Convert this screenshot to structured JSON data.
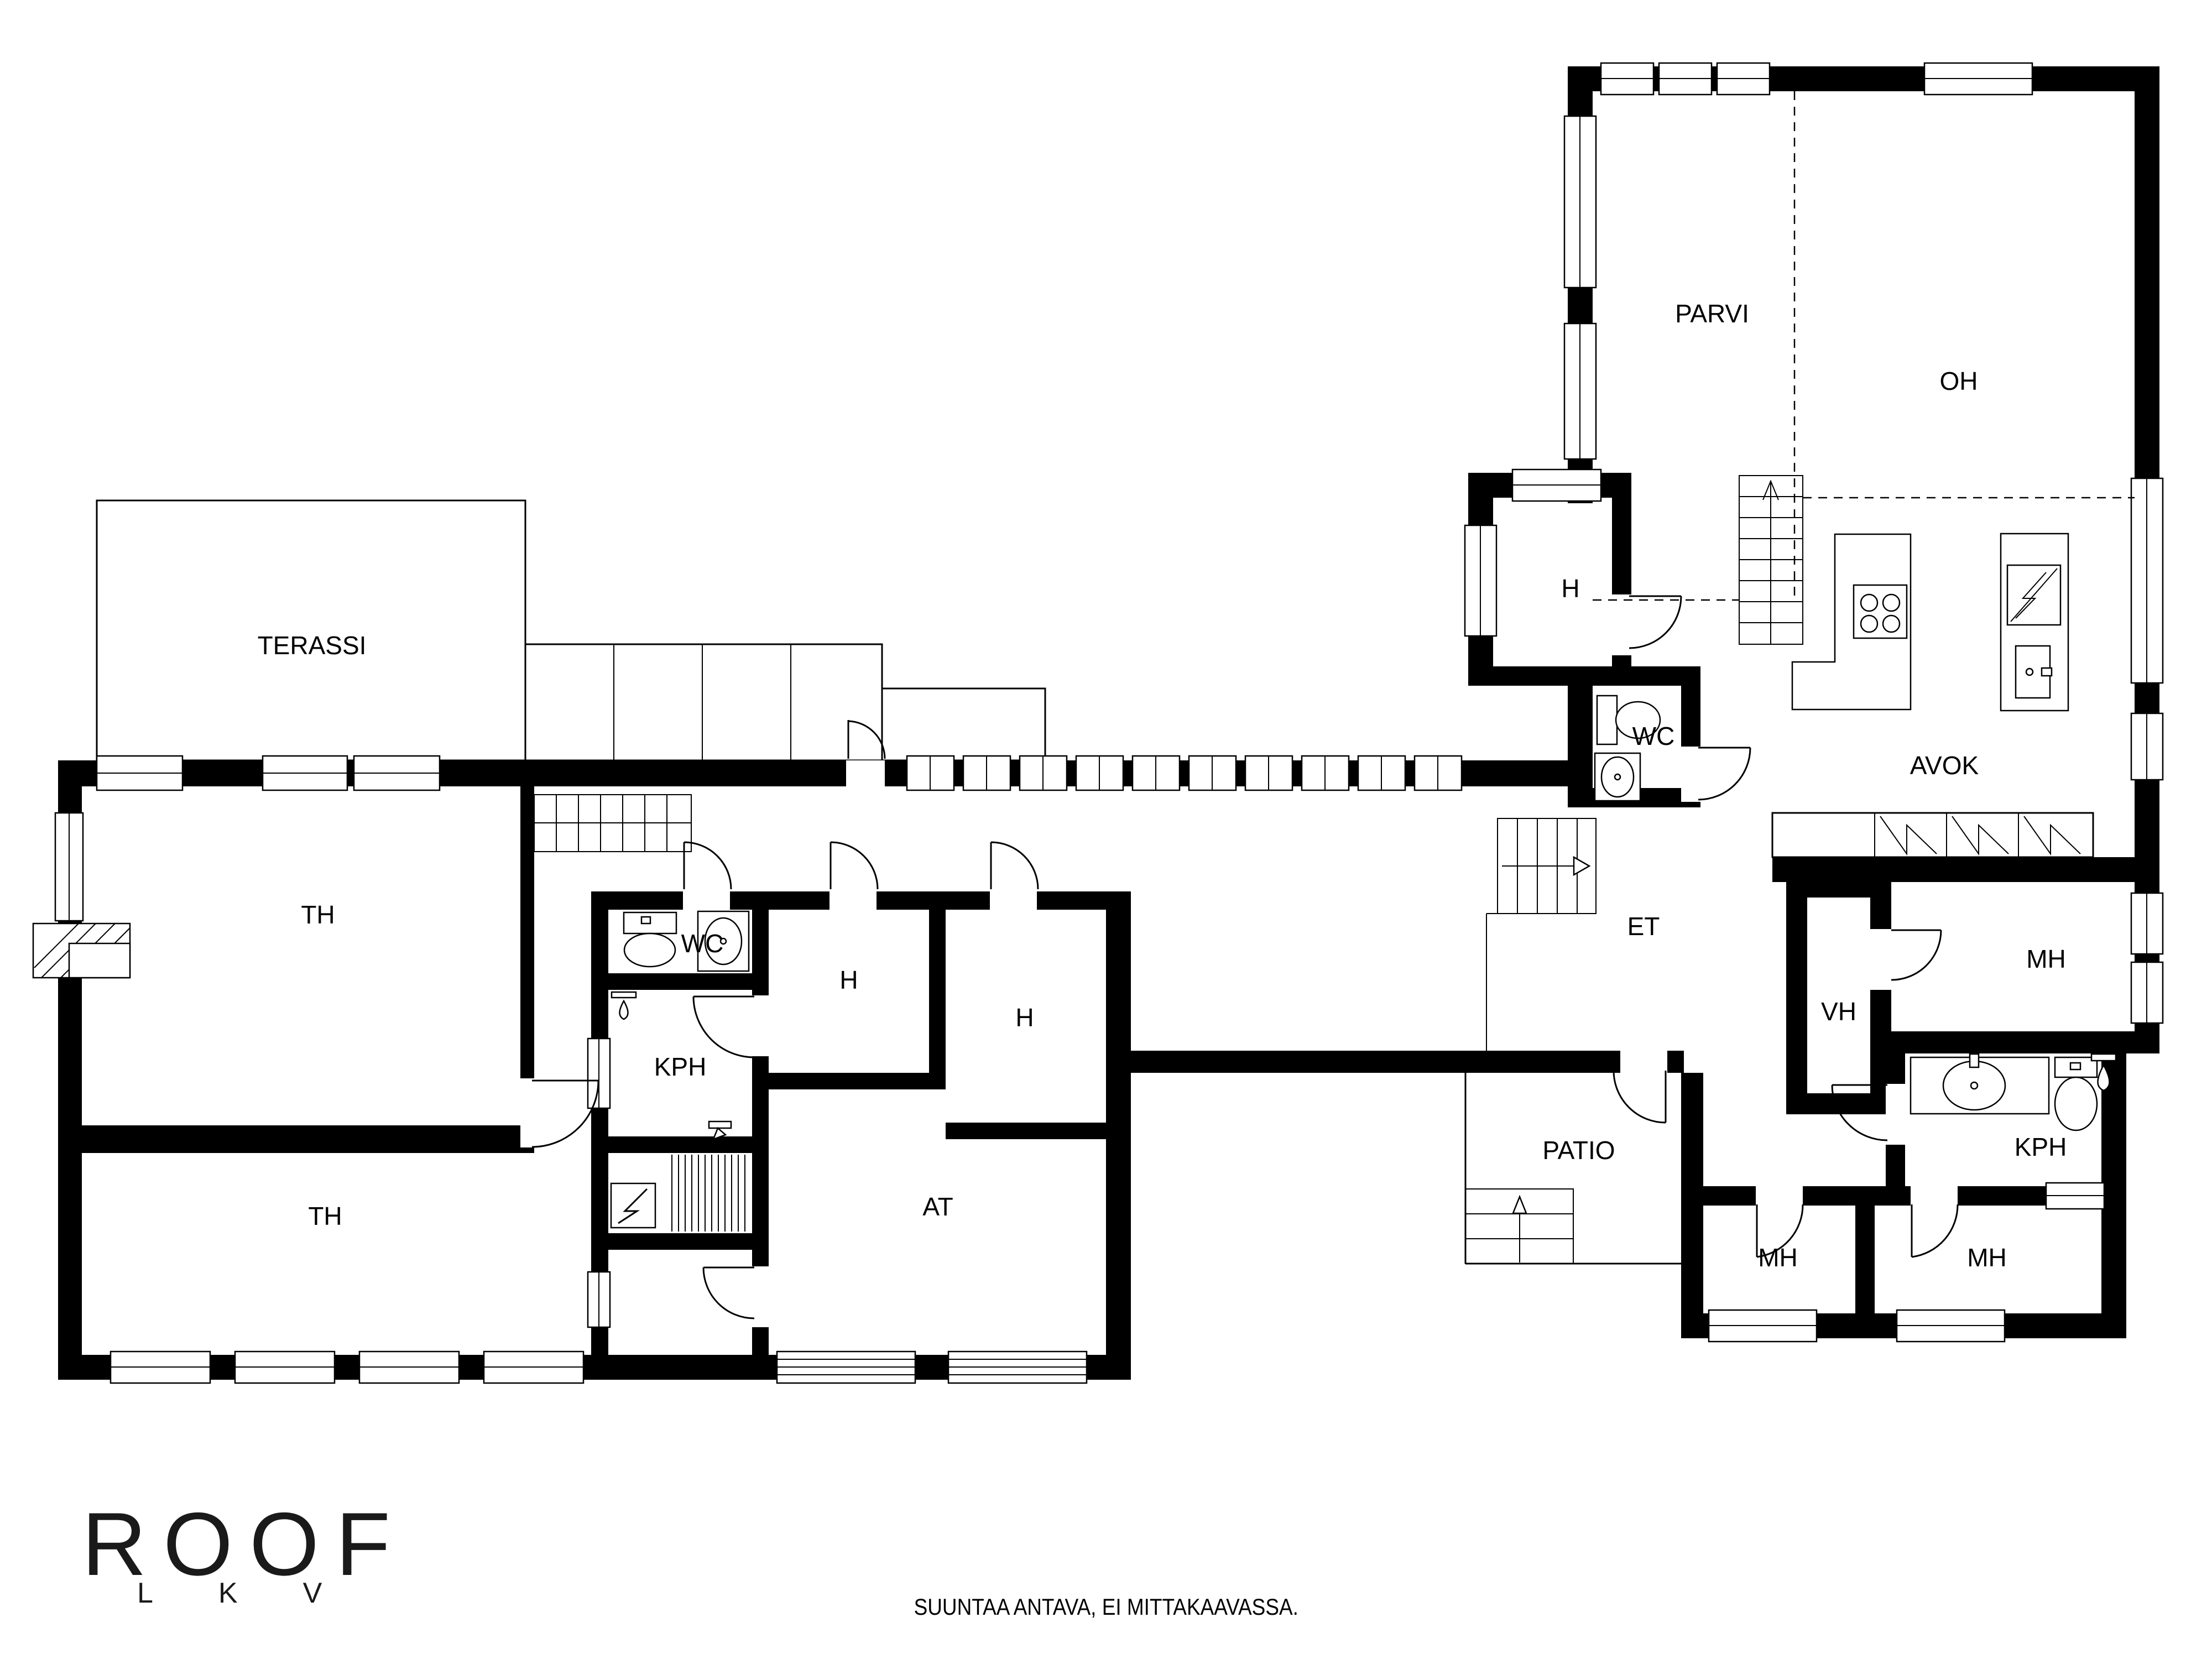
{
  "rooms": {
    "terassi": "TERASSI",
    "th_upper": "TH",
    "th_lower": "TH",
    "wc_center": "WC",
    "kph_center": "KPH",
    "h_center_1": "H",
    "h_center_2": "H",
    "at": "AT",
    "parvi": "PARVI",
    "oh": "OH",
    "h_right": "H",
    "wc_right": "WC",
    "avok": "AVOK",
    "et": "ET",
    "vh": "VH",
    "mh_right": "MH",
    "kph_right": "KPH",
    "patio": "PATIO",
    "mh_bottom_1": "MH",
    "mh_bottom_2": "MH"
  },
  "branding": {
    "logo_main": "ROOF",
    "logo_sub": "LKV"
  },
  "footer": {
    "disclaimer": "SUUNTAA ANTAVA, EI MITTAKAAVASSA."
  },
  "icons": {
    "sauna_stove": "sauna-stove-icon",
    "fireplace": "fireplace-icon",
    "cooktop": "cooktop-icon",
    "toilet": "toilet-icon",
    "sink": "sink-icon",
    "shower": "shower-icon",
    "wardrobe": "wardrobe-icon",
    "stairs": "stairs-icon",
    "chimney": "chimney-icon"
  },
  "colors": {
    "ink": "#000000",
    "background": "#ffffff"
  }
}
